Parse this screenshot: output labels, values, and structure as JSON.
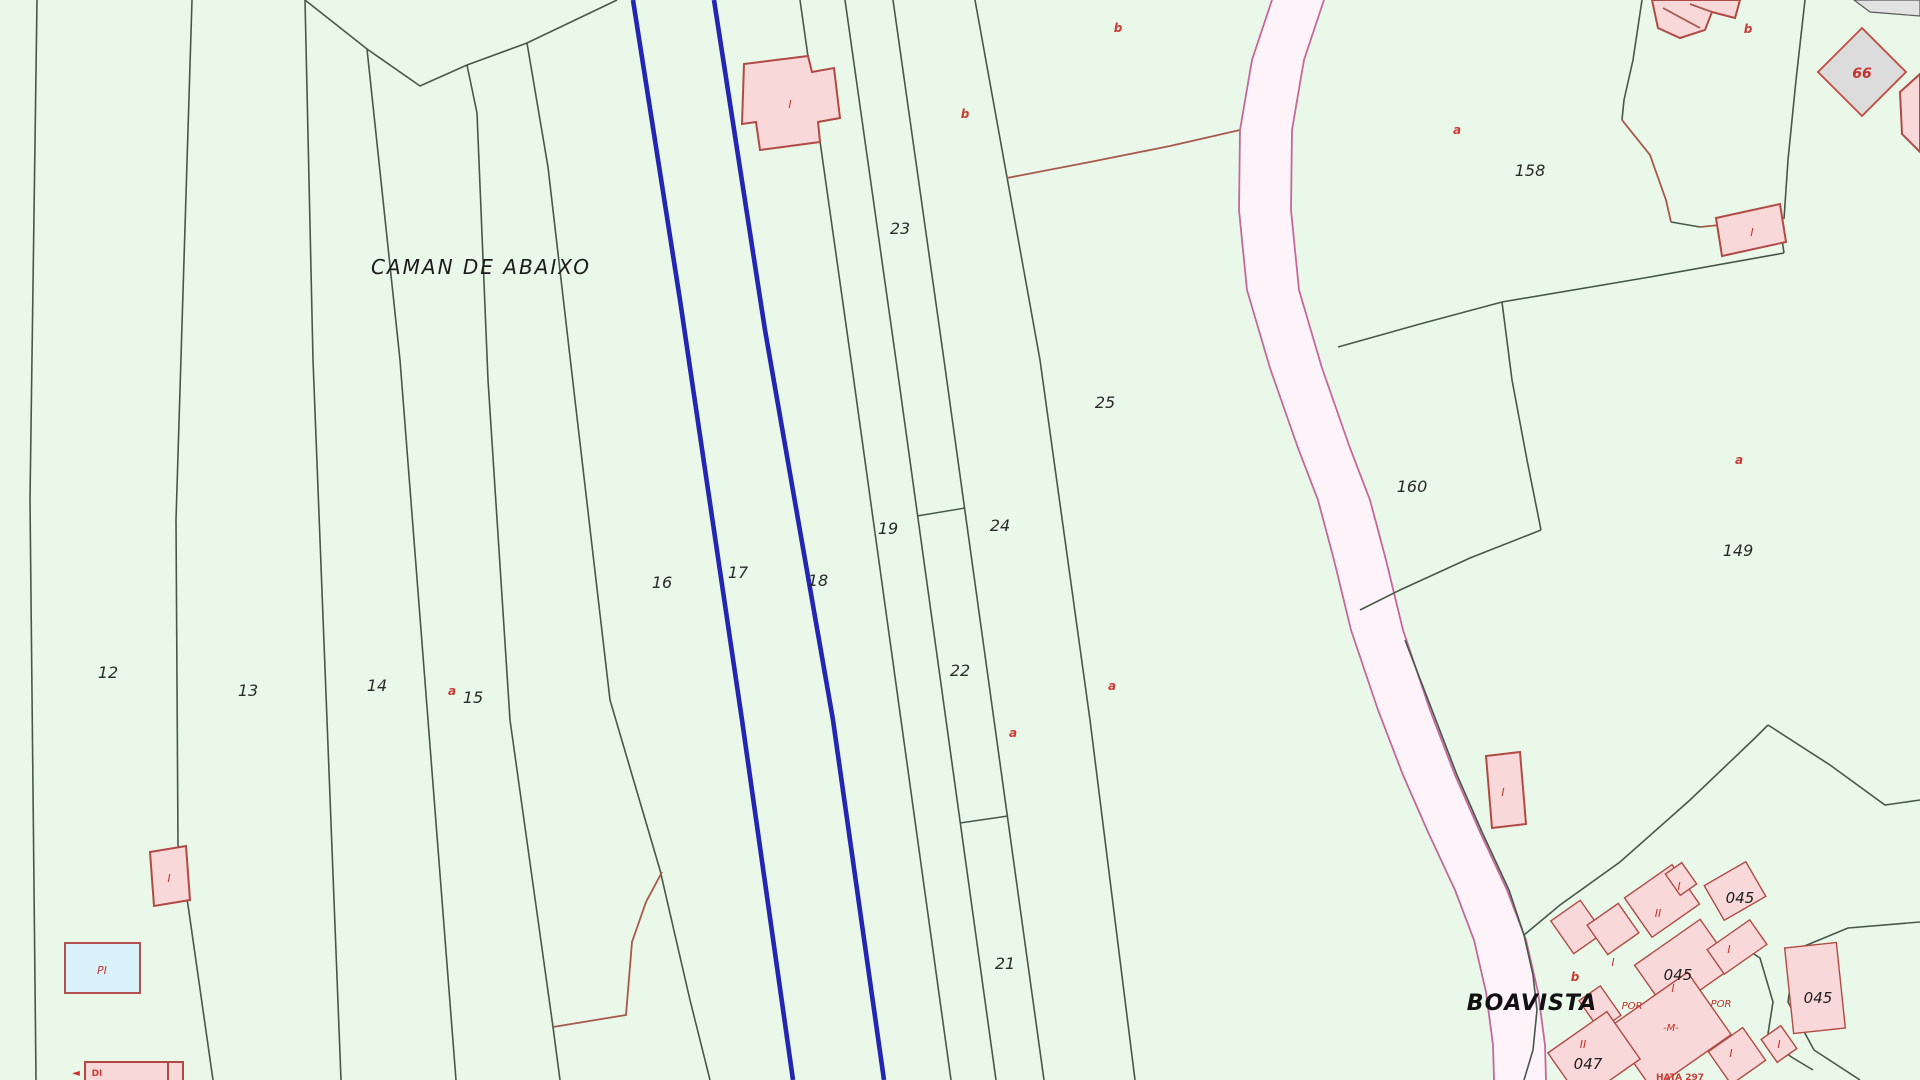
{
  "map": {
    "background_color": "#e9f8e9",
    "boundary_color": "#47584a",
    "subboundary_color": "#a8594a",
    "watercourse_color": "#2326b2",
    "road_fill": "#fdf3f9",
    "road_edge_color": "#c4699c",
    "building_fill": "#f8d8d8",
    "building_stroke": "#b14a44",
    "gray_building_fill": "#dcdcdc",
    "cyan_building_fill": "#d9f1f8",
    "place_labels": [
      {
        "id": "caman-de-abaixo",
        "text": "CAMAN DE ABAIXO",
        "x": 481,
        "y": 274,
        "cls": "lbl-place"
      },
      {
        "id": "boavista",
        "text": "BOAVISTA",
        "x": 1532,
        "y": 1010,
        "cls": "lbl-place-big"
      }
    ],
    "parcel_labels": [
      {
        "id": "12",
        "text": "12",
        "x": 108,
        "y": 678
      },
      {
        "id": "13",
        "text": "13",
        "x": 248,
        "y": 696
      },
      {
        "id": "14",
        "text": "14",
        "x": 377,
        "y": 691
      },
      {
        "id": "15",
        "text": "15",
        "x": 473,
        "y": 703
      },
      {
        "id": "16",
        "text": "16",
        "x": 662,
        "y": 588
      },
      {
        "id": "17",
        "text": "17",
        "x": 738,
        "y": 578
      },
      {
        "id": "18",
        "text": "18",
        "x": 818,
        "y": 586
      },
      {
        "id": "19",
        "text": "19",
        "x": 888,
        "y": 534
      },
      {
        "id": "21",
        "text": "21",
        "x": 1005,
        "y": 969
      },
      {
        "id": "22",
        "text": "22",
        "x": 960,
        "y": 676
      },
      {
        "id": "23",
        "text": "23",
        "x": 900,
        "y": 234
      },
      {
        "id": "24",
        "text": "24",
        "x": 1000,
        "y": 531
      },
      {
        "id": "25",
        "text": "25",
        "x": 1105,
        "y": 408
      },
      {
        "id": "149",
        "text": "149",
        "x": 1738,
        "y": 556
      },
      {
        "id": "158",
        "text": "158",
        "x": 1530,
        "y": 176
      },
      {
        "id": "160",
        "text": "160",
        "x": 1412,
        "y": 492
      }
    ],
    "urban_labels": [
      {
        "id": "045-a",
        "text": "045",
        "x": 1740,
        "y": 903
      },
      {
        "id": "045-b",
        "text": "045",
        "x": 1678,
        "y": 980
      },
      {
        "id": "045-c",
        "text": "045",
        "x": 1818,
        "y": 1003
      },
      {
        "id": "047",
        "text": "047",
        "x": 1588,
        "y": 1069
      }
    ],
    "sub_letter_labels": [
      {
        "id": "a-15",
        "text": "a",
        "x": 452,
        "y": 695
      },
      {
        "id": "a-24",
        "text": "a",
        "x": 1013,
        "y": 737
      },
      {
        "id": "a-25",
        "text": "a",
        "x": 1112,
        "y": 690
      },
      {
        "id": "a-158",
        "text": "a",
        "x": 1457,
        "y": 134
      },
      {
        "id": "a-149",
        "text": "a",
        "x": 1739,
        "y": 464
      },
      {
        "id": "b-24",
        "text": "b",
        "x": 965,
        "y": 118
      },
      {
        "id": "b-25",
        "text": "b",
        "x": 1118,
        "y": 32
      },
      {
        "id": "b-158",
        "text": "b",
        "x": 1748,
        "y": 33
      },
      {
        "id": "b-village",
        "text": "b",
        "x": 1575,
        "y": 981
      }
    ],
    "building_letter_labels": [
      {
        "id": "i-top-left-building",
        "text": "I",
        "x": 790,
        "y": 108
      },
      {
        "id": "i-left-bottom-building",
        "text": "I",
        "x": 169,
        "y": 882
      },
      {
        "id": "pi-deposit",
        "text": "PI",
        "x": 102,
        "y": 974
      },
      {
        "id": "i-east-building",
        "text": "I",
        "x": 1752,
        "y": 236
      },
      {
        "id": "i-66-diamond",
        "text": "66",
        "x": 1862,
        "y": 78
      },
      {
        "id": "i-west-village-building",
        "text": "I",
        "x": 1503,
        "y": 796
      },
      {
        "id": "i-v2",
        "text": "I",
        "x": 1613,
        "y": 966
      },
      {
        "id": "ii-v3",
        "text": "II",
        "x": 1658,
        "y": 917
      },
      {
        "id": "i-v3b",
        "text": "I",
        "x": 1679,
        "y": 890
      },
      {
        "id": "i-v4",
        "text": "I",
        "x": 1673,
        "y": 992
      },
      {
        "id": "i-v5",
        "text": "I",
        "x": 1729,
        "y": 953
      },
      {
        "id": "por-1",
        "text": "POR",
        "x": 1632,
        "y": 1009
      },
      {
        "id": "por-2",
        "text": "POR",
        "x": 1721,
        "y": 1007
      },
      {
        "id": "m-v8",
        "text": "-M-",
        "x": 1671,
        "y": 1031
      },
      {
        "id": "ii-v10",
        "text": "II",
        "x": 1583,
        "y": 1048
      },
      {
        "id": "i-v11",
        "text": "I",
        "x": 1731,
        "y": 1057
      },
      {
        "id": "i-v12",
        "text": "I",
        "x": 1779,
        "y": 1048
      },
      {
        "id": "arrow-bottom-left",
        "text": "◄",
        "x": 76,
        "y": 1076
      },
      {
        "id": "tiny-bottom-left",
        "text": "DI",
        "x": 97,
        "y": 1076
      },
      {
        "id": "tiny-village-bottom",
        "text": "HATA 297",
        "x": 1680,
        "y": 1080
      }
    ]
  }
}
